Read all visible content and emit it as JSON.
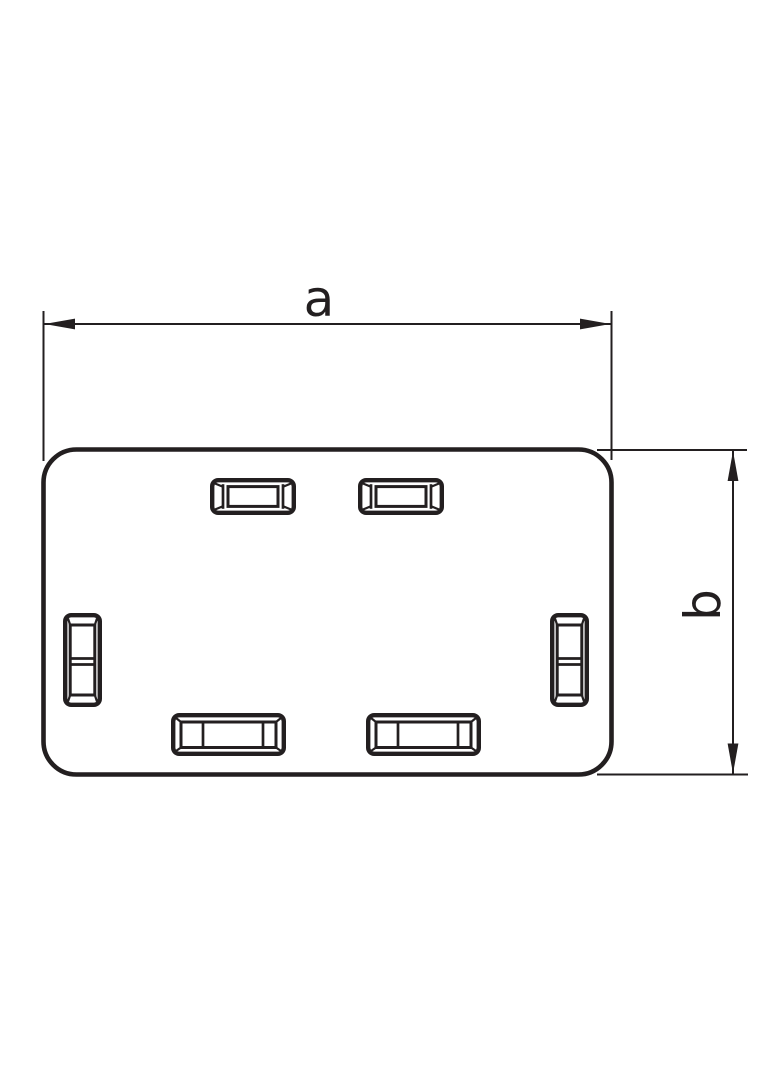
{
  "drawing": {
    "type": "technical-drawing",
    "part": "rectangular end cap with six latch slots",
    "dim_a_label": "a",
    "dim_b_label": "b"
  },
  "style": {
    "line_color": "#231f20",
    "background": "#ffffff"
  }
}
